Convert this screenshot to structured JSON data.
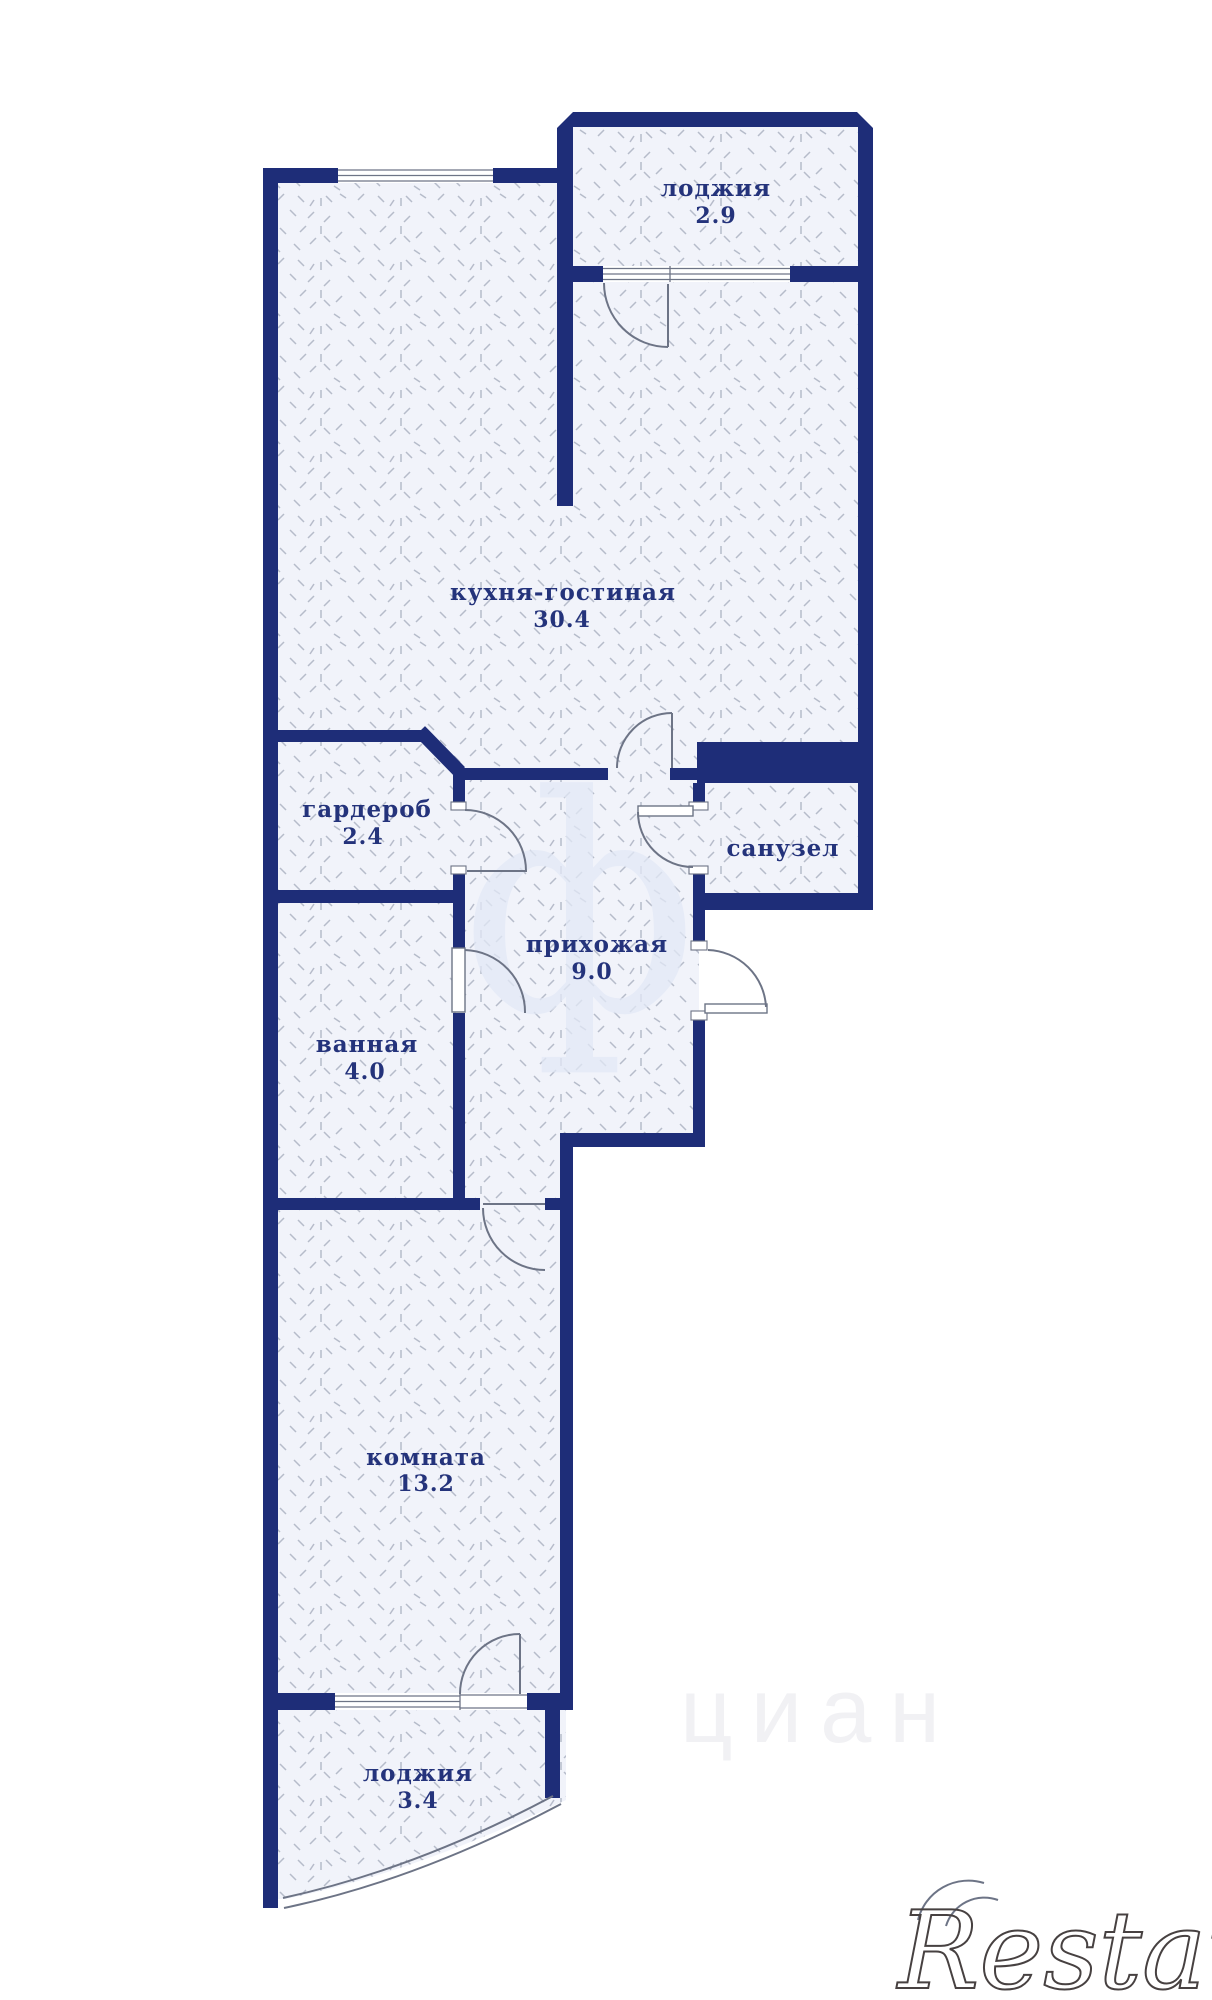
{
  "plan": {
    "rooms": [
      {
        "id": "loggia-top",
        "name": "лоджия",
        "area": "2.9"
      },
      {
        "id": "kitchen-living",
        "name": "кухня-гостиная",
        "area": "30.4"
      },
      {
        "id": "wardrobe",
        "name": "гардероб",
        "area": "2.4"
      },
      {
        "id": "bathroom-wc",
        "name": "санузел",
        "area": ""
      },
      {
        "id": "hallway",
        "name": "прихожая",
        "area": "9.0"
      },
      {
        "id": "bathroom",
        "name": "ванная",
        "area": "4.0"
      },
      {
        "id": "room",
        "name": "комната",
        "area": "13.2"
      },
      {
        "id": "loggia-bottom",
        "name": "лоджия",
        "area": "3.4"
      }
    ],
    "colors": {
      "wall": "#1e2d78",
      "room_fill": "#f1f3fa",
      "hatch_mark": "#b6bcca",
      "label": "#24337b",
      "thin_line": "#6d7486",
      "background": "#ffffff"
    },
    "watermarks": {
      "logo": "Restate",
      "portal_glyph": "ф",
      "portal_text": "циан"
    }
  }
}
